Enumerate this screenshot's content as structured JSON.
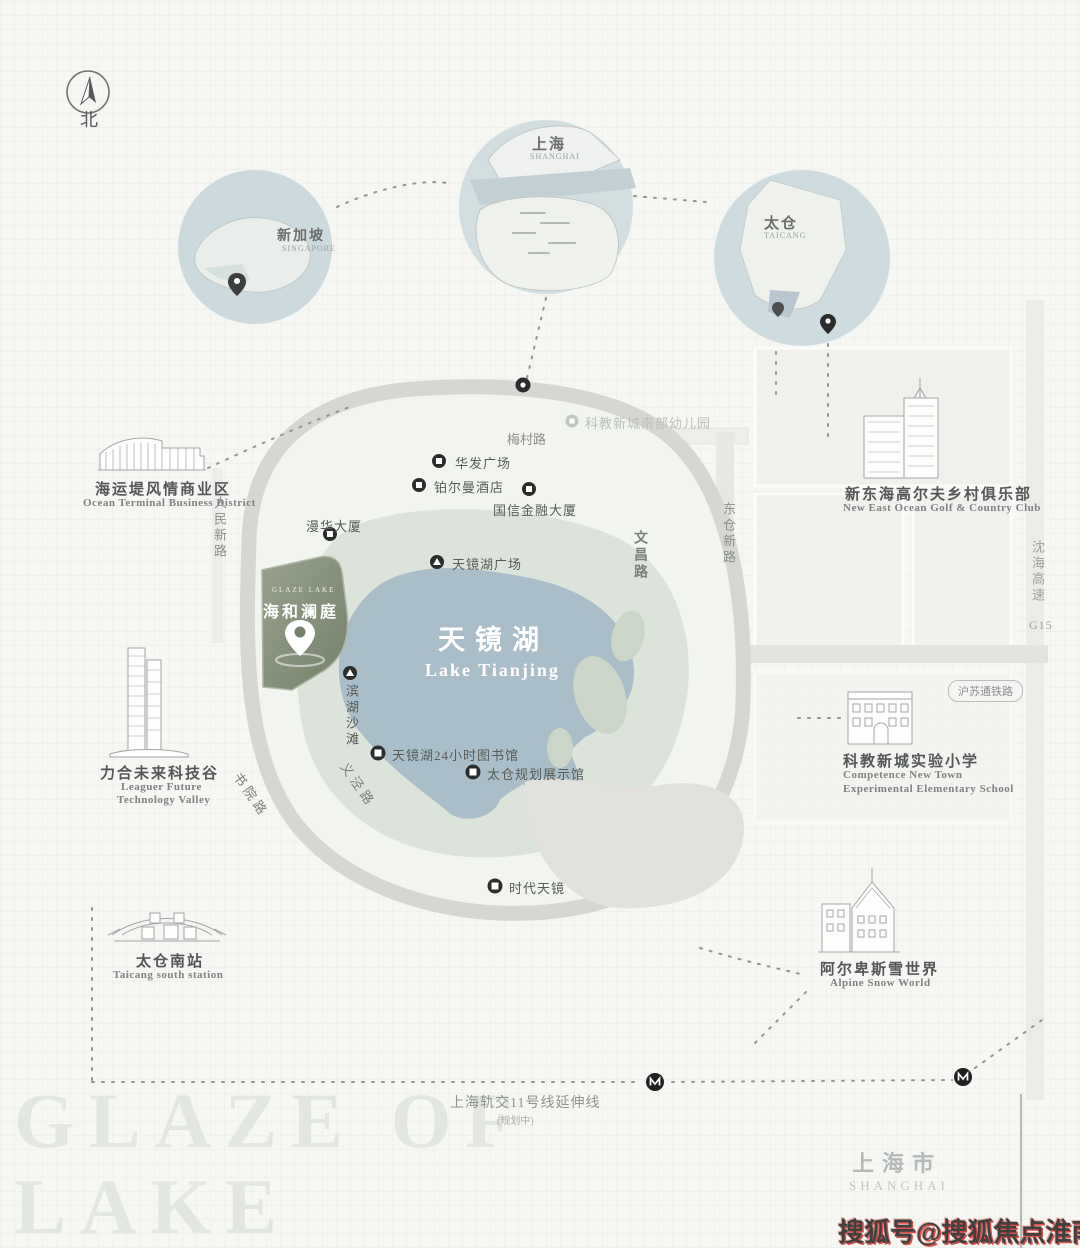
{
  "compass": {
    "north_label": "北"
  },
  "inset_circles": [
    {
      "id": "singapore",
      "label": "新加坡",
      "sublabel": "SINGAPORE"
    },
    {
      "id": "shanghai",
      "label": "上海",
      "sublabel": "SHANGHAI"
    },
    {
      "id": "taicang",
      "label": "太仓",
      "sublabel": "TAICANG"
    }
  ],
  "project": {
    "brand": "GLAZE LAKE",
    "name": "海和澜庭"
  },
  "lake": {
    "name_cn": "天镜湖",
    "name_en": "Lake Tianjing"
  },
  "roads": {
    "meicun": "梅村路",
    "renmin_xin": "人民新路",
    "wenchang": "文昌路",
    "dongcang_xin": "东仓新路",
    "shuyuan": "书院路",
    "yijing": "义泾路",
    "g15_cn": "沈海高速",
    "g15_code": "G15",
    "husutong_rail": "沪苏通铁路",
    "metro11": "上海轨交11号线延伸线",
    "metro11_note": "(规划中)"
  },
  "pois": [
    {
      "label": "华发广场"
    },
    {
      "label": "铂尔曼酒店"
    },
    {
      "label": "国信金融大厦"
    },
    {
      "label": "漫华大厦"
    },
    {
      "label": "天镜湖广场"
    },
    {
      "label": "滨湖沙滩"
    },
    {
      "label": "天镜湖24小时图书馆"
    },
    {
      "label": "太仓规划展示馆"
    },
    {
      "label": "时代天镜"
    },
    {
      "label": "科教新城南部幼儿园"
    }
  ],
  "landmarks": [
    {
      "cn": "海运堤风情商业区",
      "en": "Ocean Terminal Business District"
    },
    {
      "cn": "力合未来科技谷",
      "en1": "Leaguer Future",
      "en2": "Technology Valley"
    },
    {
      "cn": "太仓南站",
      "en": "Taicang south station"
    },
    {
      "cn": "新东海高尔夫乡村俱乐部",
      "en": "New East Ocean Golf & Country Club"
    },
    {
      "cn": "科教新城实验小学",
      "en1": "Competence New Town",
      "en2": "Experimental Elementary School"
    },
    {
      "cn": "阿尔卑斯雪世界",
      "en": "Alpine Snow World"
    }
  ],
  "background_text": {
    "line1": "GLAZE OF",
    "line2": "LAKE"
  },
  "region": {
    "cn": "上海市",
    "en": "SHANGHAI"
  },
  "watermark": "搜狐号@搜狐焦点淮南站",
  "colors": {
    "lake": "#a9bec9",
    "park": "#dce3da",
    "project_fill": "#828c76",
    "ring_road": "#d6d7d2",
    "watermark_red": "#d94f4b"
  }
}
